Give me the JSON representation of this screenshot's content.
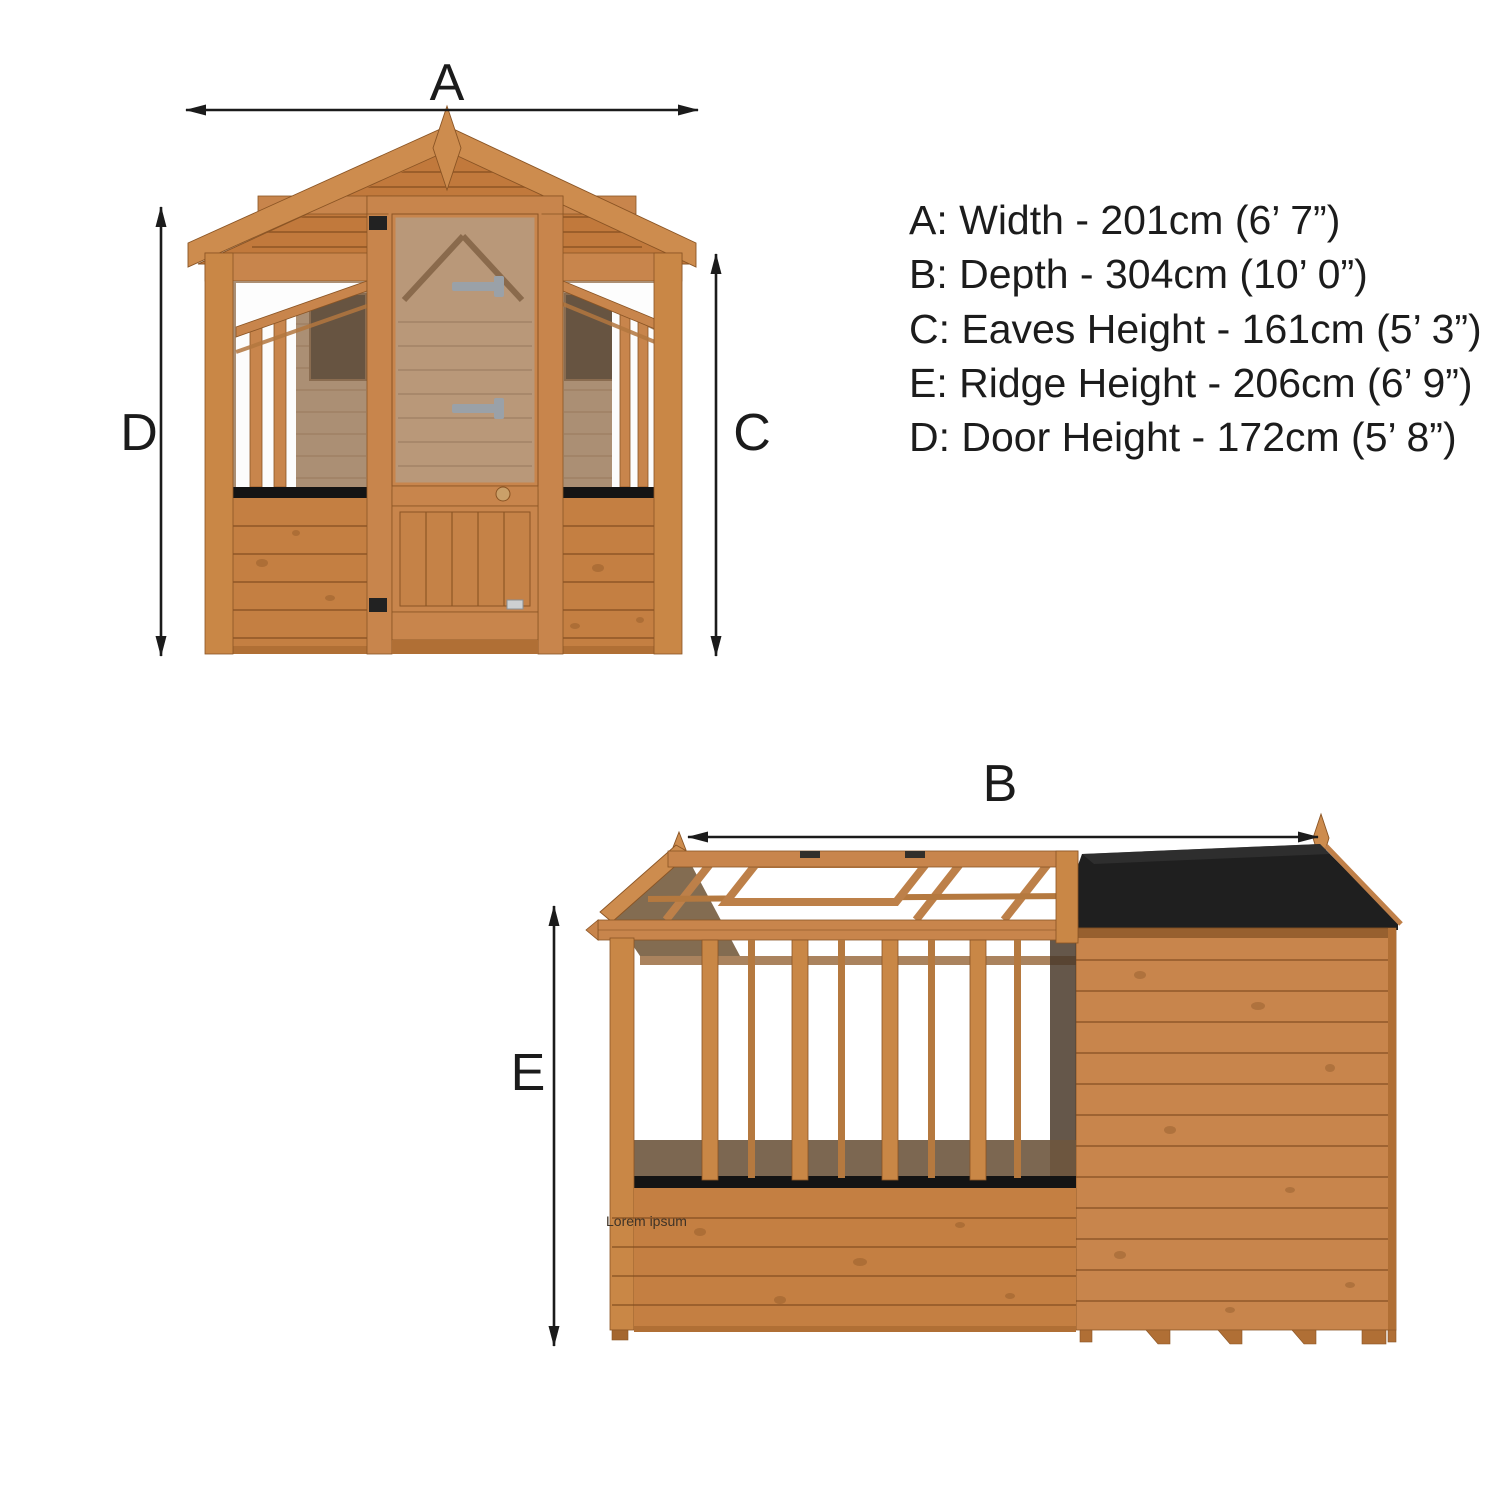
{
  "front_view": {
    "width_label": "A",
    "door_height_label": "D",
    "eaves_height_label": "C"
  },
  "side_view": {
    "depth_label": "B",
    "ridge_height_label": "E",
    "watermark": "Lorem ipsum"
  },
  "spec_list": {
    "lines": [
      "A: Width - 201cm (6’ 7”)",
      "B: Depth - 304cm (10’ 0”)",
      "C: Eaves Height - 161cm (5’ 3”)",
      "E: Ridge Height - 206cm (6’ 9”)",
      "D: Door Height - 172cm (5’ 8”)"
    ]
  },
  "colors": {
    "wood_mid": "#c8854c",
    "wood_dark": "#8a5424",
    "interior_wall": "#ab8f74",
    "window_glass": "#675441",
    "roof_felt": "#1f1f1f",
    "sill_black": "#141414",
    "annotation": "#1b1b1b",
    "background": "#ffffff"
  }
}
